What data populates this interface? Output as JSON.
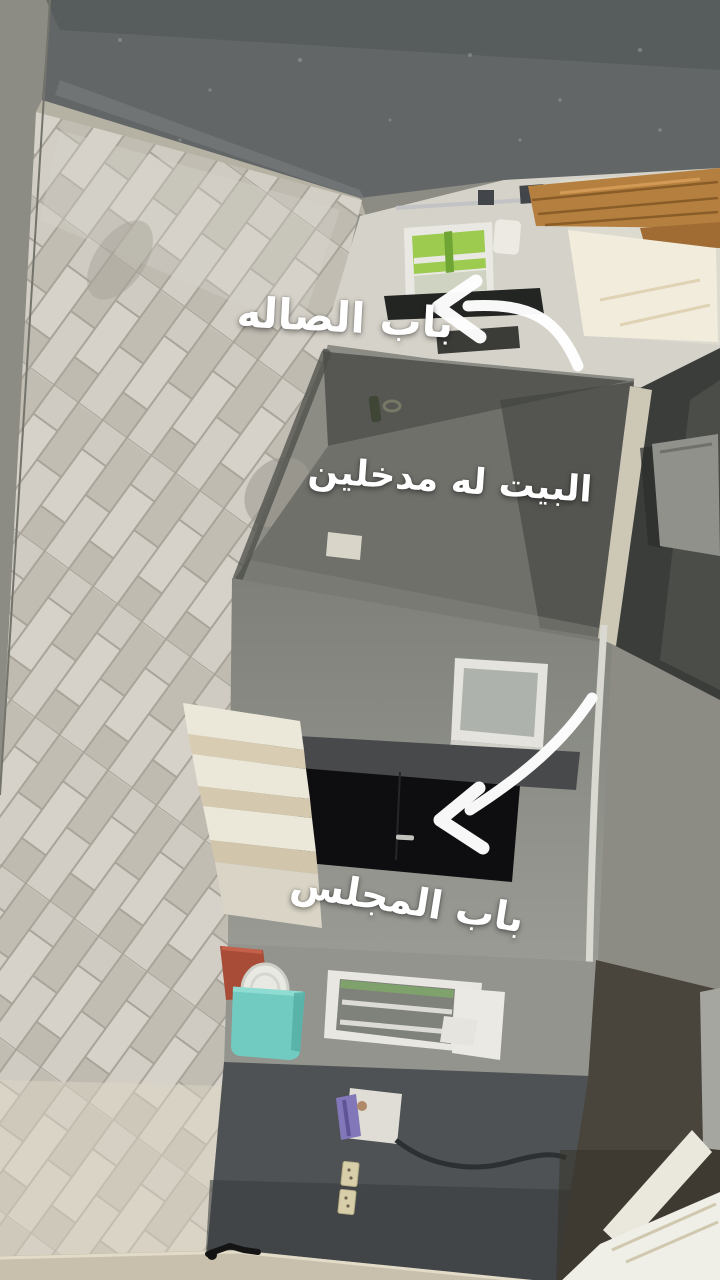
{
  "annotations": {
    "text_direction": "rtl",
    "labels": [
      {
        "id": "hall-door-label",
        "text": "باب الصاله"
      },
      {
        "id": "two-entrances-label",
        "text": "البيت له مدخلين"
      },
      {
        "id": "majlis-door-label",
        "text": "باب المجلس"
      }
    ],
    "arrows": [
      {
        "id": "arrow-to-hall-door",
        "points_at": "hall-door-opening"
      },
      {
        "id": "arrow-to-majlis-door",
        "points_at": "majlis-door"
      }
    ]
  },
  "palette": {
    "background": "#8c8c84",
    "asphalt": "#626667",
    "curb": "#b6b2a3",
    "tiles": "#cac6bd",
    "cream_wall": "#d5d2c9",
    "wood": "#b5803f",
    "daylight": "#f2ecdd",
    "green_glass": "#9ccb50",
    "slab_face": "#565752",
    "porch_floor": "#6f706a",
    "corner_trim": "#cdc7b6",
    "inner_wall": "#8d8e88",
    "lower_wall": "#93948e",
    "dark_door": "#0e0e10",
    "steps": "#ebe7d9",
    "teal_bucket": "#72cbc1",
    "red_bucket": "#a84b37",
    "utility_wall": "#4f5254",
    "purple_object": "#8277b8",
    "bottom_strip": "#c8c0ad",
    "arrow": "#ffffff"
  }
}
